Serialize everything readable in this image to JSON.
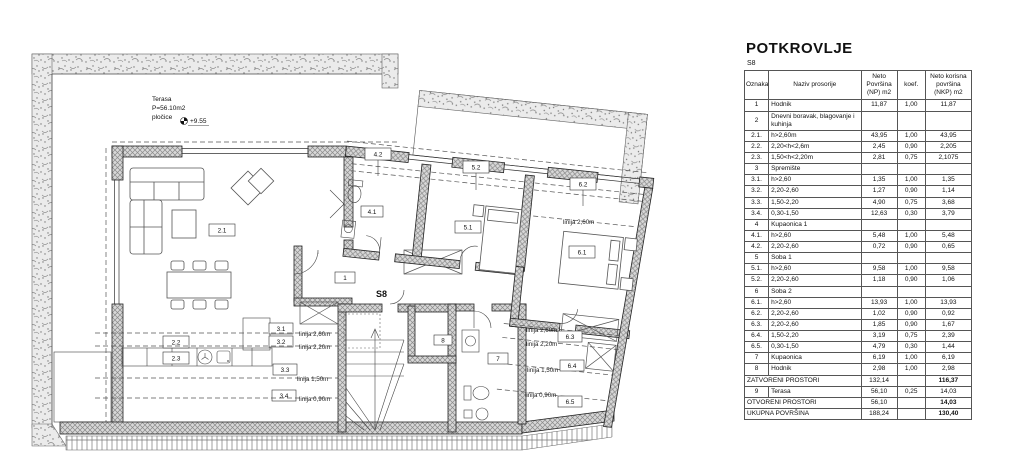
{
  "plan": {
    "unit": "S8",
    "terrace": {
      "name": "Terasa",
      "area": "P=56.10m2",
      "finish": "pločice",
      "elevation": "+9.55"
    },
    "rooms": {
      "r1": "1",
      "r21": "2.1",
      "r22": "2.2",
      "r23": "2.3",
      "r31": "3.1",
      "r32": "3.2",
      "r33": "3.3",
      "r34": "3.4",
      "r41": "4.1",
      "r42": "4.2",
      "r51": "5.1",
      "r52": "5.2",
      "r61": "6.1",
      "r62": "6.2",
      "r63": "6.3",
      "r64": "6.4",
      "r65": "6.5",
      "r7": "7",
      "r8": "8"
    },
    "lines": {
      "l260": "linija 2,60m",
      "l220": "linija 2,20m",
      "l150": "linija 1,50m",
      "l090": "linija 0,90m"
    }
  },
  "panel": {
    "title": "POTKROVLJE",
    "unit": "S8",
    "headers": [
      "Oznaka",
      "Naziv prosorije",
      "Neto Površina (NP) m2",
      "koef.",
      "Neto korisna površina (NKP) m2"
    ],
    "rows": [
      {
        "t": "d",
        "c": [
          "1",
          "Hodnik",
          "11,87",
          "1,00",
          "11,87"
        ]
      },
      {
        "t": "g",
        "c": [
          "2",
          "Dnevni boravak, blagovanje i kuhinja"
        ]
      },
      {
        "t": "d",
        "c": [
          "2.1.",
          "h>2,60m",
          "43,95",
          "1,00",
          "43,95"
        ]
      },
      {
        "t": "d",
        "c": [
          "2.2.",
          "2,20<h<2,6m",
          "2,45",
          "0,90",
          "2,205"
        ]
      },
      {
        "t": "d",
        "c": [
          "2.3.",
          "1,50<h<2,20m",
          "2,81",
          "0,75",
          "2,1075"
        ]
      },
      {
        "t": "g",
        "c": [
          "3",
          "Spremište"
        ]
      },
      {
        "t": "d",
        "c": [
          "3.1.",
          "h>2,60",
          "1,35",
          "1,00",
          "1,35"
        ]
      },
      {
        "t": "d",
        "c": [
          "3.2.",
          "2,20-2,60",
          "1,27",
          "0,90",
          "1,14"
        ]
      },
      {
        "t": "d",
        "c": [
          "3.3.",
          "1,50-2,20",
          "4,90",
          "0,75",
          "3,68"
        ]
      },
      {
        "t": "d",
        "c": [
          "3.4.",
          "0,30-1,50",
          "12,63",
          "0,30",
          "3,79"
        ]
      },
      {
        "t": "g",
        "c": [
          "4",
          "Kupaonica 1"
        ]
      },
      {
        "t": "d",
        "c": [
          "4.1.",
          "h>2,60",
          "5,48",
          "1,00",
          "5,48"
        ]
      },
      {
        "t": "d",
        "c": [
          "4.2.",
          "2,20-2,60",
          "0,72",
          "0,90",
          "0,65"
        ]
      },
      {
        "t": "g",
        "c": [
          "5",
          "Soba 1"
        ]
      },
      {
        "t": "d",
        "c": [
          "5.1.",
          "h>2,60",
          "9,58",
          "1,00",
          "9,58"
        ]
      },
      {
        "t": "d",
        "c": [
          "5.2.",
          "2,20-2,60",
          "1,18",
          "0,90",
          "1,06"
        ]
      },
      {
        "t": "g",
        "c": [
          "6",
          "Soba 2"
        ]
      },
      {
        "t": "d",
        "c": [
          "6.1.",
          "h>2,60",
          "13,93",
          "1,00",
          "13,93"
        ]
      },
      {
        "t": "d",
        "c": [
          "6.2.",
          "2,20-2,60",
          "1,02",
          "0,90",
          "0,92"
        ]
      },
      {
        "t": "d",
        "c": [
          "6.3.",
          "2,20-2,60",
          "1,85",
          "0,90",
          "1,67"
        ]
      },
      {
        "t": "d",
        "c": [
          "6.4.",
          "1,50-2,20",
          "3,19",
          "0,75",
          "2,39"
        ]
      },
      {
        "t": "d",
        "c": [
          "6.5.",
          "0,30-1,50",
          "4,79",
          "0,30",
          "1,44"
        ]
      },
      {
        "t": "d",
        "c": [
          "7",
          "Kupaonica",
          "6,19",
          "1,00",
          "6,19"
        ]
      },
      {
        "t": "d",
        "c": [
          "8",
          "Hodnik",
          "2,98",
          "1,00",
          "2,98"
        ]
      },
      {
        "t": "s",
        "c": [
          "ZATVORENI PROSTORI",
          "132,14",
          "",
          "116,37"
        ]
      },
      {
        "t": "d",
        "c": [
          "9",
          "Terasa",
          "56,10",
          "0,25",
          "14,03"
        ]
      },
      {
        "t": "s",
        "c": [
          "OTVORENI PROSTORI",
          "56,10",
          "",
          "14,03"
        ]
      },
      {
        "t": "s",
        "c": [
          "UKUPNA POVRŠINA",
          "188,24",
          "",
          "130,40"
        ]
      }
    ]
  }
}
